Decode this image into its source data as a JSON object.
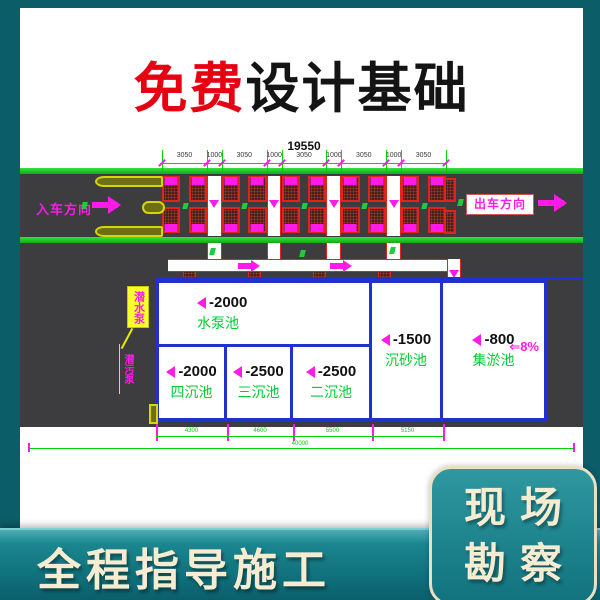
{
  "title": {
    "free": "免费",
    "rest": "设计基础"
  },
  "dims": {
    "total_top": "19550",
    "sub": [
      "3050",
      "1000",
      "3050",
      "1000",
      "3050",
      "1000",
      "3050",
      "1000",
      "3050"
    ],
    "bottom": [
      "4300",
      "4600",
      "5500",
      "5150"
    ],
    "bottom_total": "40000"
  },
  "road": {
    "entry_label": "入车方向",
    "exit_label": "出车方向"
  },
  "pools": {
    "pump": {
      "depth": "-2000",
      "name": "水泵池"
    },
    "four": {
      "depth": "-2000",
      "name": "四沉池"
    },
    "three": {
      "depth": "-2500",
      "name": "三沉池"
    },
    "two": {
      "depth": "-2500",
      "name": "二沉池"
    },
    "sand": {
      "depth": "-1500",
      "name": "沉砂池"
    },
    "sludge": {
      "depth": "-800",
      "name": "集淤池"
    },
    "slope_label": "⇐8%"
  },
  "annotations": {
    "pump_box": "潜水泵",
    "pump_strip": "潜污泵"
  },
  "footer": {
    "left_banner": "全程指导施工",
    "right_line1": "现场",
    "right_line2": "勘察"
  },
  "colors": {
    "frame_teal": "#0b5d68",
    "road_gray": "#3d3d40",
    "lane_green": "#1fc226",
    "cad_green": "#00d400",
    "cad_magenta": "#ff1ae8",
    "cad_red": "#e0241c",
    "cad_blue": "#2230cf",
    "title_red": "#e60012",
    "banner_cream": "#f6ecd2"
  }
}
